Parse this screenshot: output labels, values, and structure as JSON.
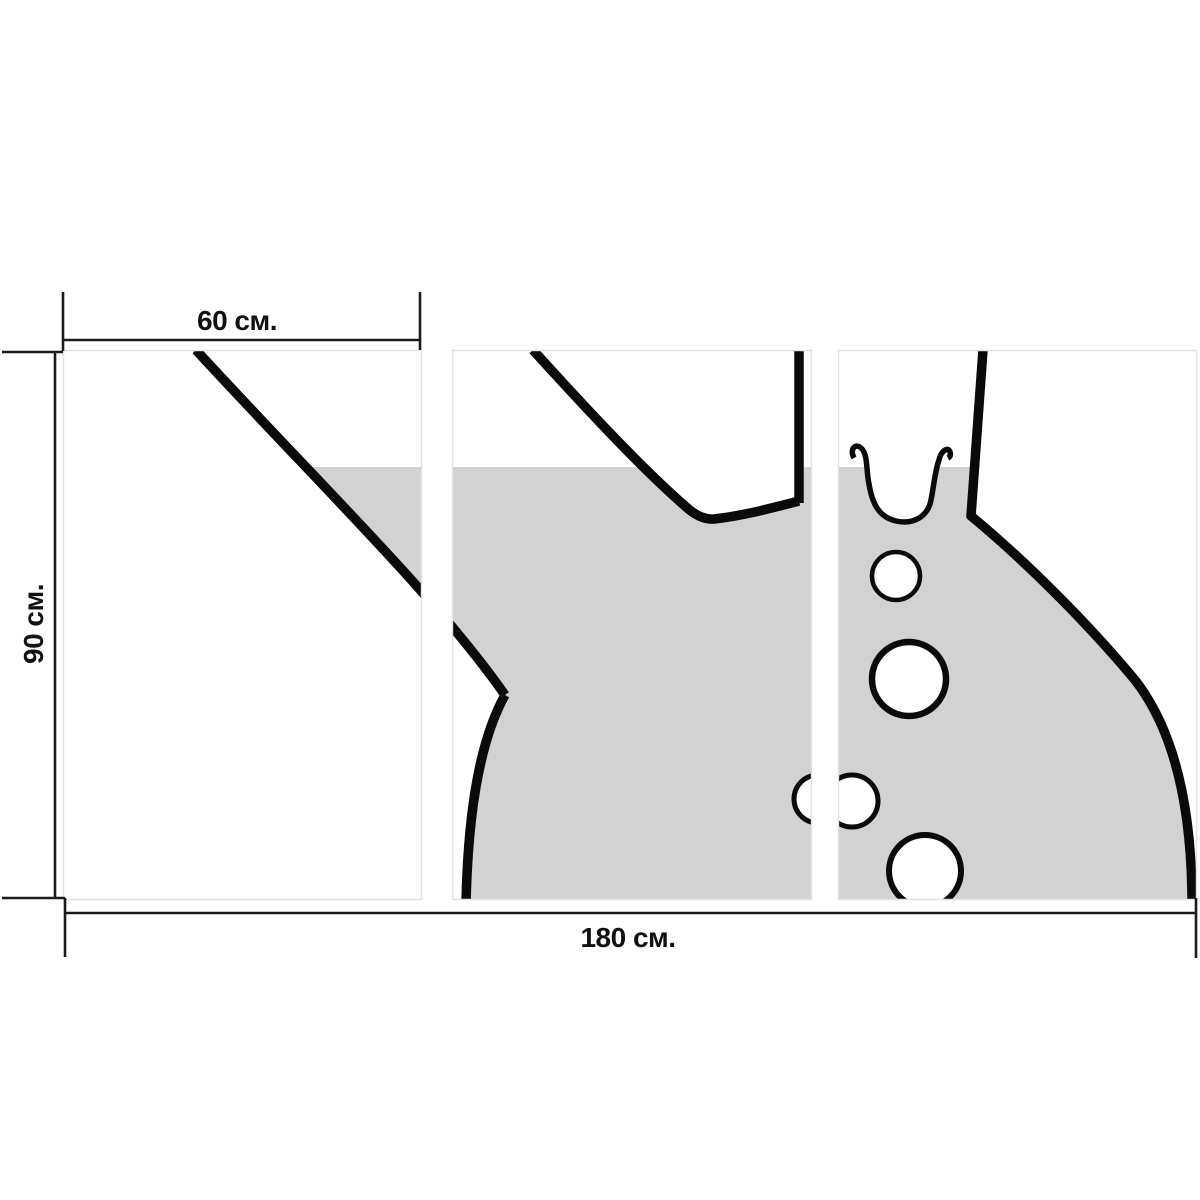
{
  "figure": {
    "description": "Dimension diagram of a three-panel (triptych) wall print depicting a two-neck chemistry flask filled with liquid and rising bubbles",
    "background_color": "#ffffff",
    "liquid_color": "#d2d2d2",
    "outline_color": "#0a0a0a",
    "panel_border_color": "#e2e2e2",
    "dimension_line_color": "#1b1b1b",
    "liquid_level_y": 467,
    "panels": [
      {
        "x": 63,
        "y": 350,
        "w": 359,
        "h": 550
      },
      {
        "x": 452,
        "y": 350,
        "w": 360,
        "h": 550
      },
      {
        "x": 838,
        "y": 350,
        "w": 359,
        "h": 550
      }
    ],
    "shapes": [
      {
        "kind": "path",
        "name": "liquid-fill",
        "clip": true,
        "fill": "#d2d2d2",
        "stroke": "none",
        "sw": 0,
        "d": "M196,350 C320,485 435,595 505,695 C480,740 468,810 466,902 L1191,902 C1192,795 1170,725 1135,680 C1085,620 1022,558 971,516 L983,350 L799,350 L799,501 C772,508 742,516 714,519 Q700,520 685,506 C652,477 610,435 533,350 Z"
      },
      {
        "kind": "path",
        "name": "liquid-surface-void-fill",
        "fill": "#ffffff",
        "stroke": "none",
        "sw": 0,
        "d": "M862,446 C868,456 866,470 869,484 C872,502 878,517 896,521 C914,525 928,516 931,500 C934,485 935,471 939,460 L941,446 Z"
      },
      {
        "kind": "circle",
        "name": "bubble-small-upper",
        "cx": 896,
        "cy": 576,
        "r": 24,
        "fill": "#ffffff",
        "stroke": "#0a0a0a",
        "sw": 4.5
      },
      {
        "kind": "circle",
        "name": "bubble-large-middle",
        "cx": 909,
        "cy": 679,
        "r": 37,
        "fill": "#ffffff",
        "stroke": "#0a0a0a",
        "sw": 6.5
      },
      {
        "kind": "circle",
        "name": "bubble-behind-gap",
        "cx": 818,
        "cy": 799,
        "r": 24,
        "fill": "#ffffff",
        "stroke": "#0a0a0a",
        "sw": 5
      },
      {
        "kind": "circle",
        "name": "bubble-right-of-gap",
        "cx": 852,
        "cy": 801,
        "r": 26,
        "fill": "#ffffff",
        "stroke": "#0a0a0a",
        "sw": 5
      },
      {
        "kind": "circle",
        "name": "bubble-bottom",
        "cx": 925,
        "cy": 871,
        "r": 36,
        "fill": "#ffffff",
        "stroke": "#0a0a0a",
        "sw": 6
      },
      {
        "kind": "path",
        "name": "flask-neck-left-wall",
        "fill": "none",
        "stroke": "#0a0a0a",
        "sw": 9.5,
        "d": "M196,350 C320,485 435,595 505,695"
      },
      {
        "kind": "path",
        "name": "flask-body-left-side",
        "fill": "none",
        "stroke": "#0a0a0a",
        "sw": 9.5,
        "d": "M505,695 C480,740 468,810 466,904"
      },
      {
        "kind": "path",
        "name": "flask-neck-right-wall-and-saddle",
        "fill": "none",
        "stroke": "#0a0a0a",
        "sw": 9.5,
        "d": "M533,350 C610,435 652,477 685,506 Q700,520 714,519 C742,516 772,508 799,501"
      },
      {
        "kind": "path",
        "name": "flask-top-neck-left-wall",
        "fill": "none",
        "stroke": "#0a0a0a",
        "sw": 9.5,
        "d": "M799,350 L799,503"
      },
      {
        "kind": "path",
        "name": "flask-top-neck-right-wall-and-body",
        "fill": "none",
        "stroke": "#0a0a0a",
        "sw": 9.5,
        "d": "M983,350 L971,516 C1022,558 1085,620 1135,680 C1170,725 1192,795 1192,904"
      },
      {
        "kind": "path",
        "name": "liquid-surface-void-outline",
        "fill": "none",
        "stroke": "#0a0a0a",
        "sw": 5.5,
        "d": "M854,458 C849,449 856,442 862,449 C868,456 866,470 869,484 C872,502 878,517 896,521 C914,525 928,516 931,500 C934,485 935,471 939,460 C941,451 948,446 950,452 C951,455 950,457 948,458"
      },
      {
        "kind": "rect",
        "name": "mask-above-panels",
        "x": 0,
        "y": 0,
        "w": 1200,
        "h": 350,
        "fill": "#ffffff"
      },
      {
        "kind": "rect",
        "name": "mask-below-panels",
        "x": 0,
        "y": 900,
        "w": 1200,
        "h": 300,
        "fill": "#ffffff"
      },
      {
        "kind": "rect",
        "name": "gap-between-panel-1-2",
        "x": 422,
        "y": 344,
        "w": 30,
        "h": 562,
        "fill": "#ffffff"
      },
      {
        "kind": "rect",
        "name": "gap-between-panel-2-3",
        "x": 812,
        "y": 344,
        "w": 26,
        "h": 562,
        "fill": "#ffffff"
      },
      {
        "kind": "rect",
        "name": "mask-left-of-panels",
        "x": 0,
        "y": 340,
        "w": 63,
        "h": 570,
        "fill": "#ffffff"
      },
      {
        "kind": "rect",
        "name": "mask-right-of-panels",
        "x": 1197,
        "y": 340,
        "w": 3,
        "h": 570,
        "fill": "#ffffff"
      },
      {
        "kind": "rect",
        "name": "panel-1-border",
        "x": 63.5,
        "y": 350.5,
        "w": 358,
        "h": 549,
        "fill": "none",
        "stroke": "#e2e2e2",
        "sw": 1.4
      },
      {
        "kind": "rect",
        "name": "panel-2-border",
        "x": 452.5,
        "y": 350.5,
        "w": 359,
        "h": 549,
        "fill": "none",
        "stroke": "#e2e2e2",
        "sw": 1.4
      },
      {
        "kind": "rect",
        "name": "panel-3-border",
        "x": 838.5,
        "y": 350.5,
        "w": 358,
        "h": 549,
        "fill": "none",
        "stroke": "#e2e2e2",
        "sw": 1.4
      },
      {
        "kind": "path",
        "name": "dimension-width-60",
        "fill": "none",
        "stroke": "#1b1b1b",
        "sw": 2.6,
        "d": "M63,292 L63,351 M420,292 L420,350 M63,340 L420,340"
      },
      {
        "kind": "path",
        "name": "dimension-height-90",
        "fill": "none",
        "stroke": "#1b1b1b",
        "sw": 2.6,
        "d": "M55,352 L55,898 M2,352 L63,352 M2,898 L65,898"
      },
      {
        "kind": "path",
        "name": "dimension-total-180",
        "fill": "none",
        "stroke": "#1b1b1b",
        "sw": 2.6,
        "d": "M65,898 L65,957 M1196,898 L1196,958 M65,913 L1196,913"
      }
    ]
  },
  "dimensions": {
    "panel_width_label": "60 см.",
    "height_label": "90 см.",
    "total_width_label": "180 см.",
    "panel_width_label_pos": {
      "x": 237,
      "y": 321
    },
    "height_label_pos": {
      "x": 34,
      "y": 624
    },
    "total_width_label_pos": {
      "x": 628,
      "y": 938
    }
  }
}
